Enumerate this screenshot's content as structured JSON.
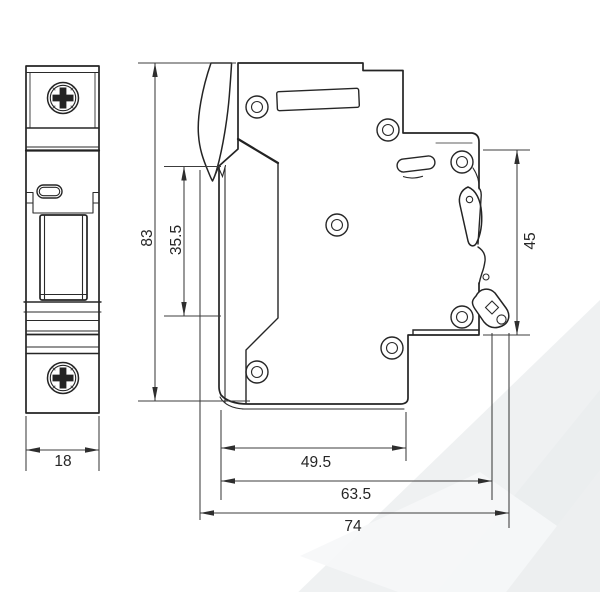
{
  "drawing": {
    "dimensions": {
      "front_width": "18",
      "overall_height": "83",
      "front_face_height": "35.5",
      "din_section_height": "45",
      "depth_body": "49.5",
      "depth_to_din_latch": "63.5",
      "overall_depth": "74"
    },
    "colors": {
      "line": "#242424",
      "dimension_line": "#3c3c3c",
      "background": "#ffffff",
      "watermark_band": "#eef0f1"
    }
  }
}
